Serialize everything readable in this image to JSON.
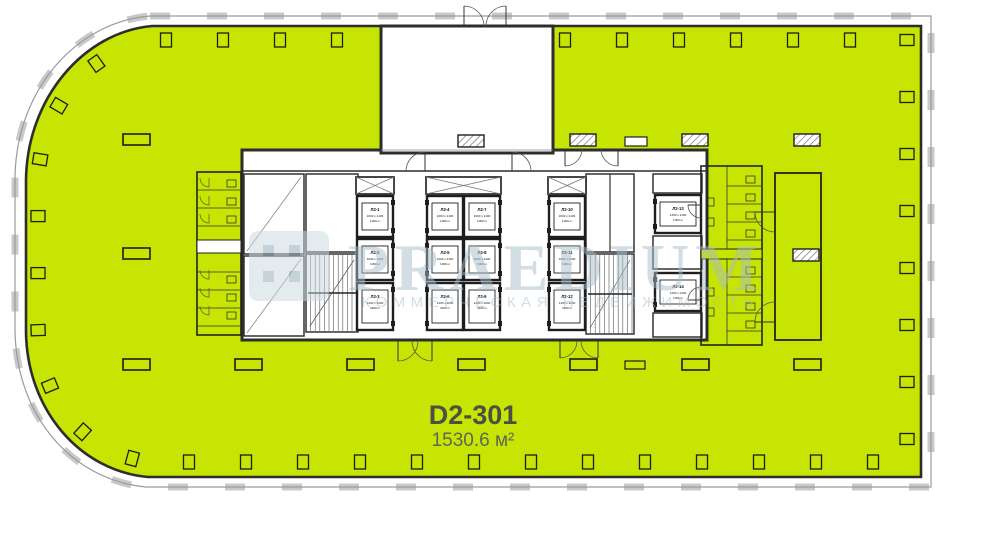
{
  "unit": {
    "code": "D2-301",
    "area": "1530.6 м²"
  },
  "watermark": {
    "brand": "PRAEDIUM",
    "tagline": "КОММЕРЧЕСКАЯ НЕДВИЖИМОСТЬ"
  },
  "colors": {
    "highlight": "#c6e502",
    "wall": "#2d2d2d",
    "thin_line": "#555555",
    "glazing": "#9a9a9a",
    "sill": "#c9c9c9",
    "watermark": "#a7bcca",
    "watermark_logo": "#c9d8e0",
    "watermark_logo_cell": "#8fa6b5",
    "unit_label": "#4b4f44",
    "unit_sublabel": "#5f6657"
  },
  "elevators": [
    {
      "id": "Л2-1",
      "size": "1600 х 2100",
      "capacity": "1000 кг"
    },
    {
      "id": "Л2-2",
      "size": "1600 х 2100",
      "capacity": "1000 кг"
    },
    {
      "id": "Л2-3",
      "size": "1400 х 2200",
      "capacity": "3400 кг"
    },
    {
      "id": "Л2-4",
      "size": "1600 х 2100",
      "capacity": "1000 кг"
    },
    {
      "id": "Л2-5",
      "size": "1600 х 2100",
      "capacity": "1000 кг"
    },
    {
      "id": "Л2-6",
      "size": "1400 х 2200",
      "capacity": "3400 кг"
    },
    {
      "id": "Л2-7",
      "size": "1600 х 2100",
      "capacity": "1000 кг"
    },
    {
      "id": "Л2-8",
      "size": "1600 х 2100",
      "capacity": "1000 кг"
    },
    {
      "id": "Л2-9",
      "size": "1400 х 2200",
      "capacity": "3400 кг"
    },
    {
      "id": "Л2-10",
      "size": "1600 х 2100",
      "capacity": "1000 кг"
    },
    {
      "id": "Л2-11",
      "size": "1600 х 2100",
      "capacity": "1000 кг"
    },
    {
      "id": "Л2-12",
      "size": "1400 х 2200",
      "capacity": "3400 кг"
    },
    {
      "id": "Л2-13",
      "size": "1450 х 2100",
      "capacity": "1000 кг"
    },
    {
      "id": "Л2-14",
      "size": "1450 х 2100",
      "capacity": "1000 кг"
    }
  ]
}
